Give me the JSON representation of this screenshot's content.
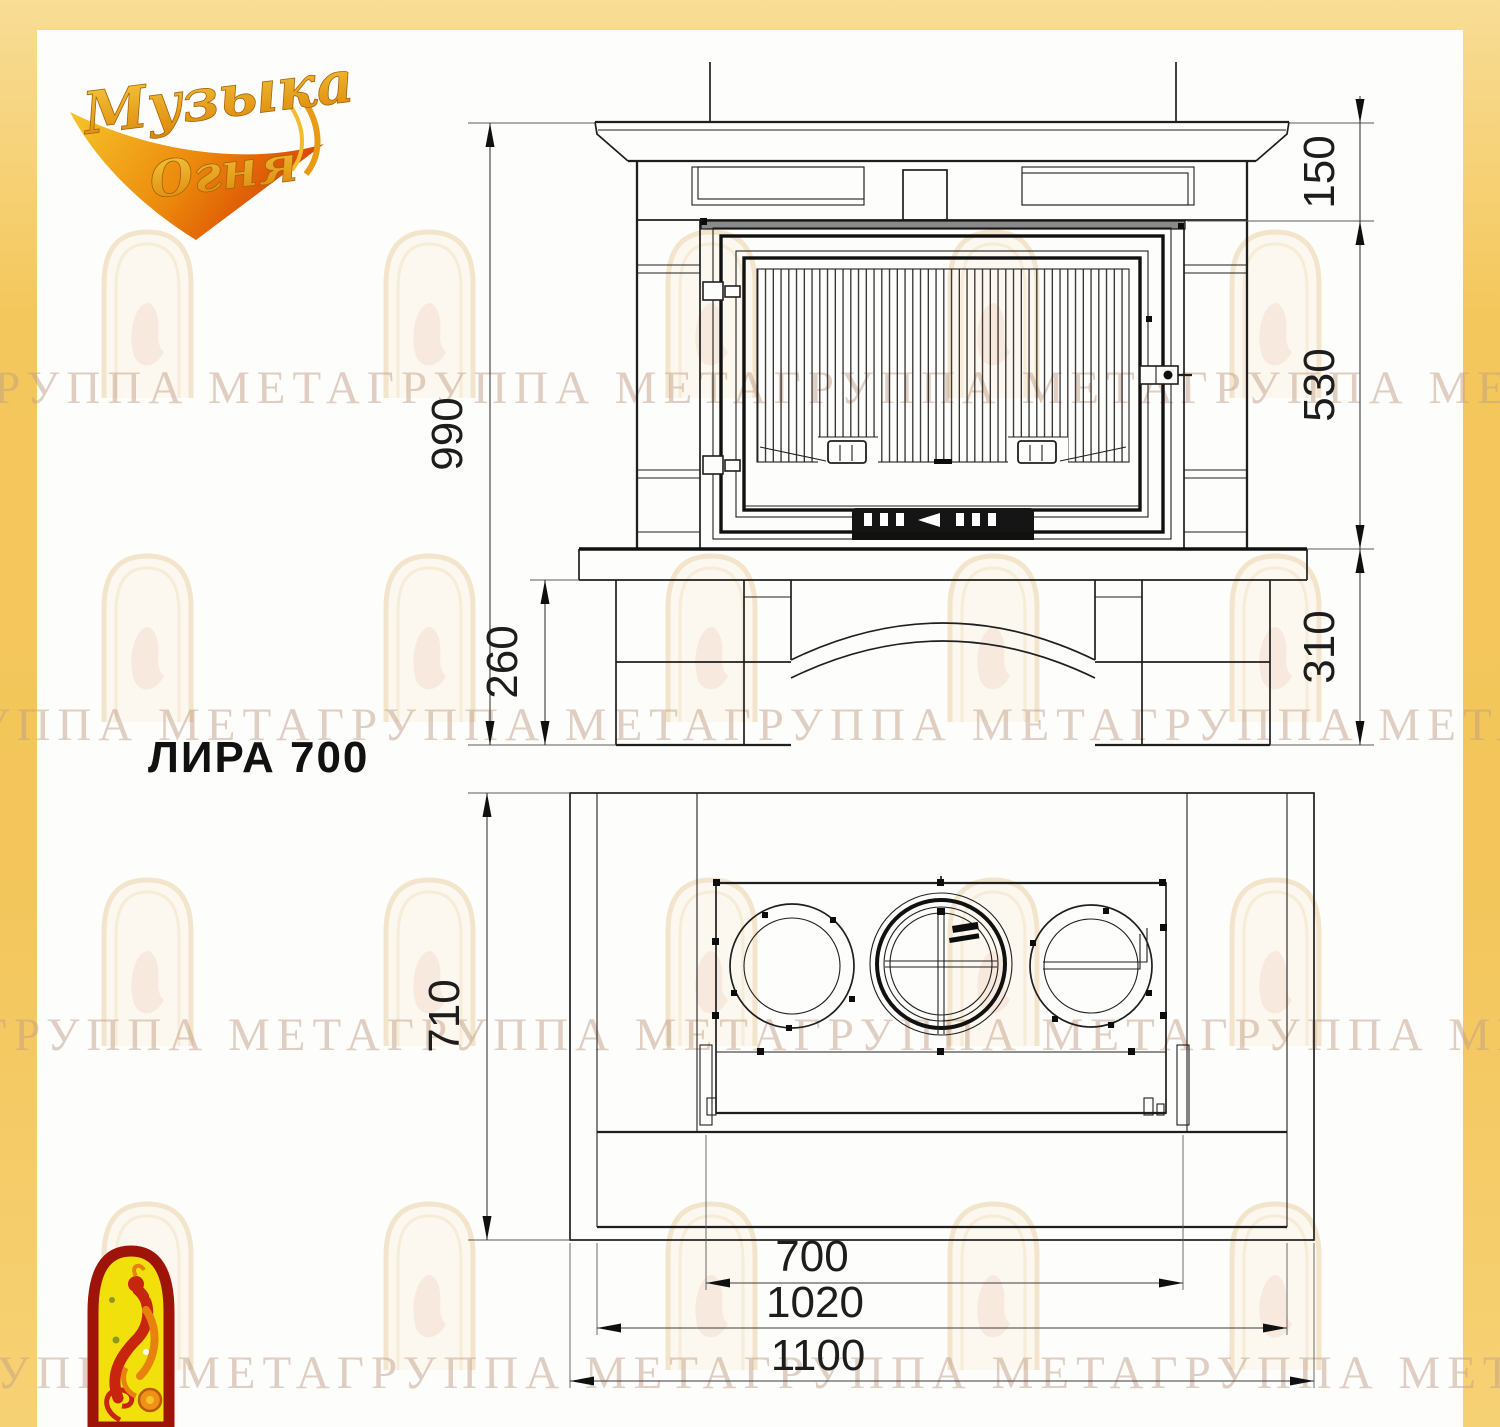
{
  "brand": {
    "word1": "Музыка",
    "word2": "Огня"
  },
  "model": {
    "label": "ЛИРА 700"
  },
  "watermark": {
    "text": "ГРУППА МЕТАГРУППА МЕТАГРУППА МЕТАГРУППА МЕТА"
  },
  "front_view": {
    "dims": {
      "total_height": "990",
      "top_section": "150",
      "firebox_height": "530",
      "base_height": "310",
      "hearth_base": "260"
    }
  },
  "plan_view": {
    "dims": {
      "depth": "710",
      "firebox_width": "700",
      "inner_width": "1020",
      "overall_width": "1100"
    }
  },
  "colors": {
    "frame_yellow": "#f3c55a",
    "paper": "#fdfdfc",
    "line": "#1f1f1f",
    "watermark": "#c19f86",
    "logo_gold": "#eaa81f",
    "logo_flame": "#dd4d04",
    "emblem_red": "#9e1408",
    "emblem_yellow": "#f2e00c"
  }
}
